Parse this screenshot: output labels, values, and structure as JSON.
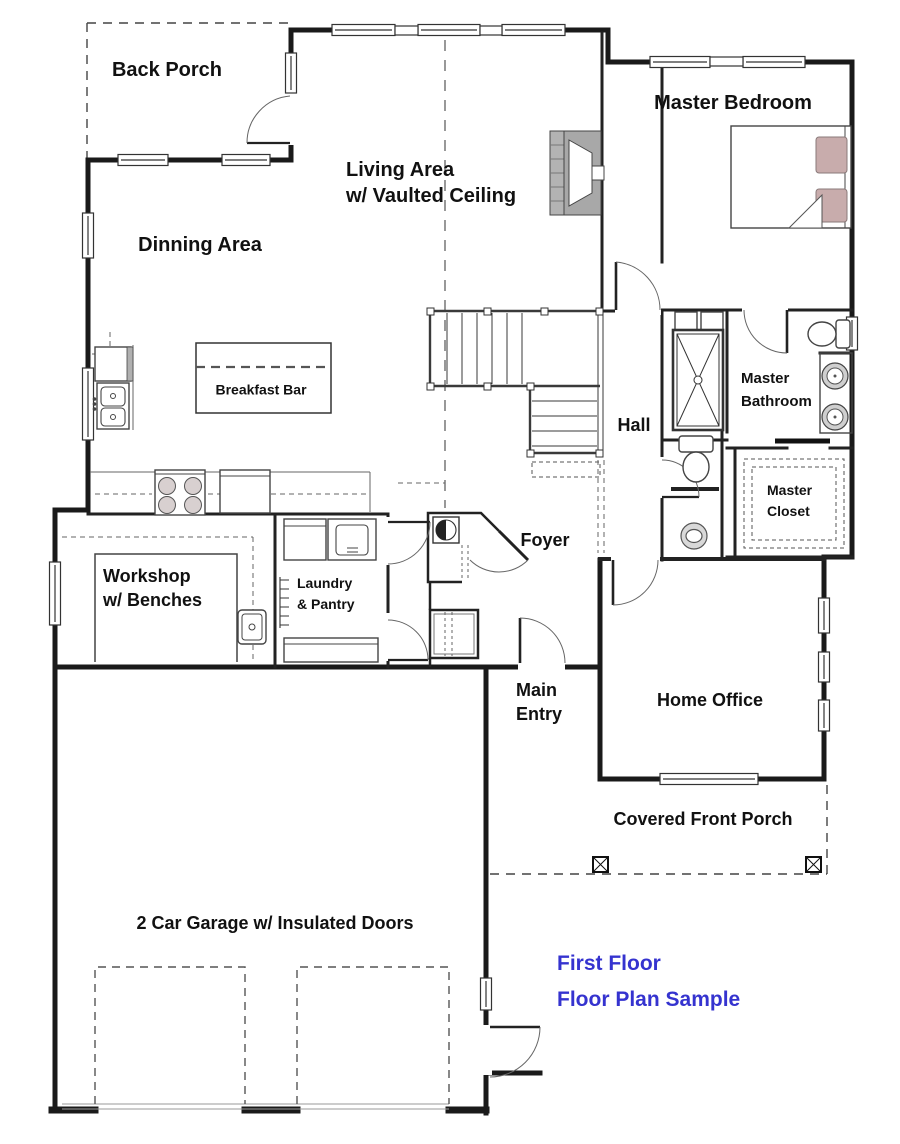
{
  "colors": {
    "caption": "#3533cf",
    "pillow": "#c8acac",
    "fireplace": "#a8a8a8",
    "wall": "#1a1a1a",
    "burner": "#d8d0d0"
  },
  "labels": {
    "back_porch": "Back Porch",
    "master_bedroom": "Master Bedroom",
    "living_area": "Living Area\nw/ Vaulted Ceiling",
    "dinning_area": "Dinning Area",
    "breakfast_bar": "Breakfast Bar",
    "hall": "Hall",
    "master_bathroom": "Master\nBathroom",
    "master_closet": "Master\nCloset",
    "foyer": "Foyer",
    "workshop": "Workshop\nw/ Benches",
    "laundry_pantry": "Laundry\n& Pantry",
    "main_entry": "Main\nEntry",
    "home_office": "Home Office",
    "covered_front_porch": "Covered Front Porch",
    "garage": "2 Car Garage w/ Insulated Doors"
  },
  "caption": {
    "line1": "First Floor",
    "line2": "Floor Plan Sample",
    "text": "First Floor\nFloor Plan Sample"
  }
}
